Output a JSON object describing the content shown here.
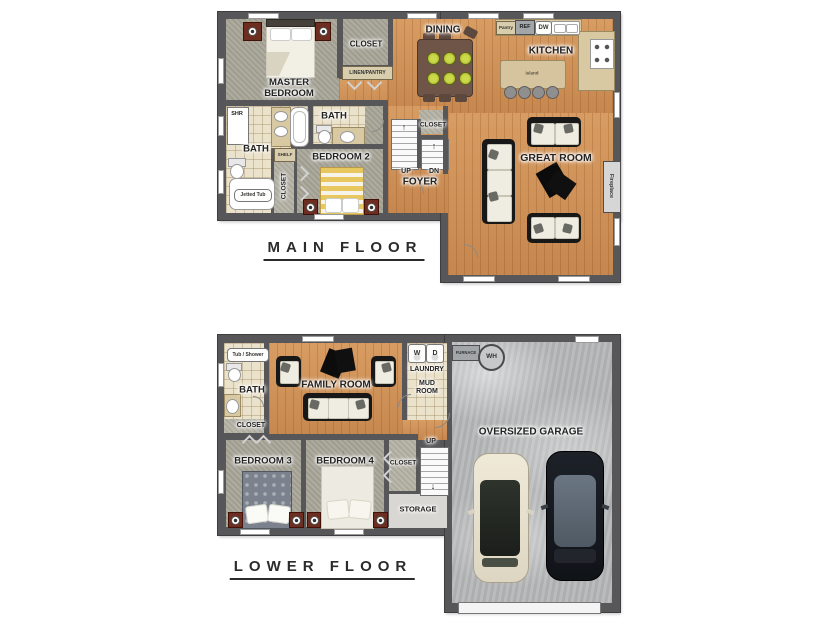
{
  "floors": {
    "main": {
      "title": "MAIN FLOOR",
      "labels": {
        "master_bedroom": "MASTER BEDROOM",
        "closet": "CLOSET",
        "linen_pantry": "LINEN/PANTRY",
        "dining": "DINING",
        "pantry": "Pantry",
        "ref": "REF",
        "dw": "DW",
        "kitchen": "KITCHEN",
        "island": "Island",
        "shr": "SHR",
        "bath_master": "BATH",
        "bath_2": "BATH",
        "shelf": "SHELF",
        "closet_vertical": "CLOSET",
        "jetted_tub": "Jetted Tub",
        "bedroom_2": "BEDROOM 2",
        "up": "UP",
        "dn": "DN",
        "foyer": "FOYER",
        "closet_foyer": "CLOSET",
        "great_room": "GREAT ROOM",
        "fireplace": "Fireplace"
      }
    },
    "lower": {
      "title": "LOWER FLOOR",
      "labels": {
        "tub_shower": "Tub / Shower",
        "bath": "BATH",
        "closet": "CLOSET",
        "family_room": "FAMILY ROOM",
        "washer": "W",
        "dryer": "D",
        "laundry": "LAUNDRY",
        "mud_room": "MUD ROOM",
        "furnace": "FURNACE",
        "water_heater": "WH",
        "up": "UP",
        "bedroom_3": "BEDROOM 3",
        "bedroom_4": "BEDROOM 4",
        "closet_bedroom4": "CLOSET",
        "storage": "STORAGE",
        "garage": "OVERSIZED GARAGE"
      }
    }
  },
  "icons": {
    "up_arrow": "↑",
    "down_arrow": "↓"
  },
  "colors": {
    "wall": "#57575a",
    "wood_floor": "#cf9055",
    "carpet": "#a8a598",
    "tile": "#ebe2cb",
    "concrete": "#b4b6b7",
    "nightstand": "#6d2d20",
    "plate_green": "#b8c93b"
  }
}
